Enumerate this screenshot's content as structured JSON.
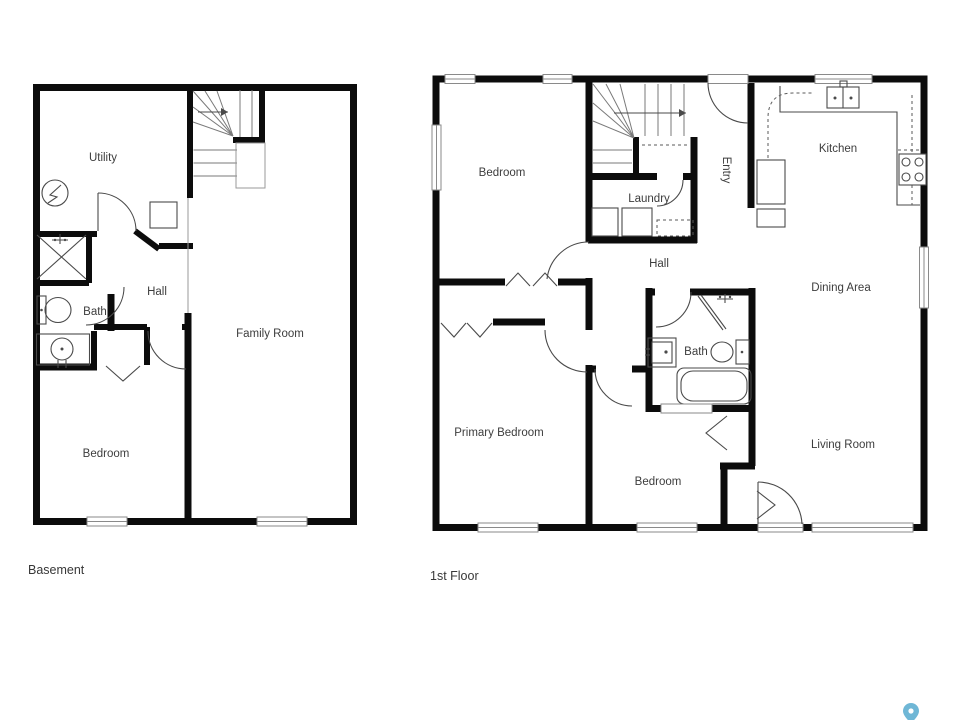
{
  "page": {
    "background": "#ffffff",
    "type": "floor-plan"
  },
  "colors": {
    "wall": "#0c0c0c",
    "fixture_line": "#4a4a4a",
    "label_text": "#3d3d3d",
    "window_line": "#8a8a8a",
    "pin": "#6fb7d6"
  },
  "basement": {
    "caption": "Basement",
    "rooms": {
      "utility": "Utility",
      "hall": "Hall",
      "bath": "Bath",
      "bedroom": "Bedroom",
      "family_room": "Family Room"
    }
  },
  "first_floor": {
    "caption": "1st Floor",
    "rooms": {
      "bedroom_top": "Bedroom",
      "laundry": "Laundry",
      "entry": "Entry",
      "kitchen": "Kitchen",
      "hall": "Hall",
      "dining": "Dining Area",
      "bath": "Bath",
      "primary_bedroom": "Primary Bedroom",
      "bedroom_bottom": "Bedroom",
      "living_room": "Living Room"
    }
  },
  "icons": {
    "electrical_panel": "electrical-panel-icon",
    "water_heater": "water-heater-icon",
    "shower_basement": "shower-icon",
    "toilet_basement": "toilet-icon",
    "sink_basement": "sink-icon",
    "stairs_basement": "stairs-icon",
    "stairs_first": "stairs-icon",
    "washer": "washer-icon",
    "dryer": "dryer-icon",
    "kitchen_sink": "kitchen-sink-icon",
    "stove": "stove-icon",
    "vanity_first": "sink-icon",
    "toilet_first": "toilet-icon",
    "bathtub": "bathtub-icon",
    "shower_first": "shower-icon",
    "map_pin": "map-pin-icon"
  }
}
